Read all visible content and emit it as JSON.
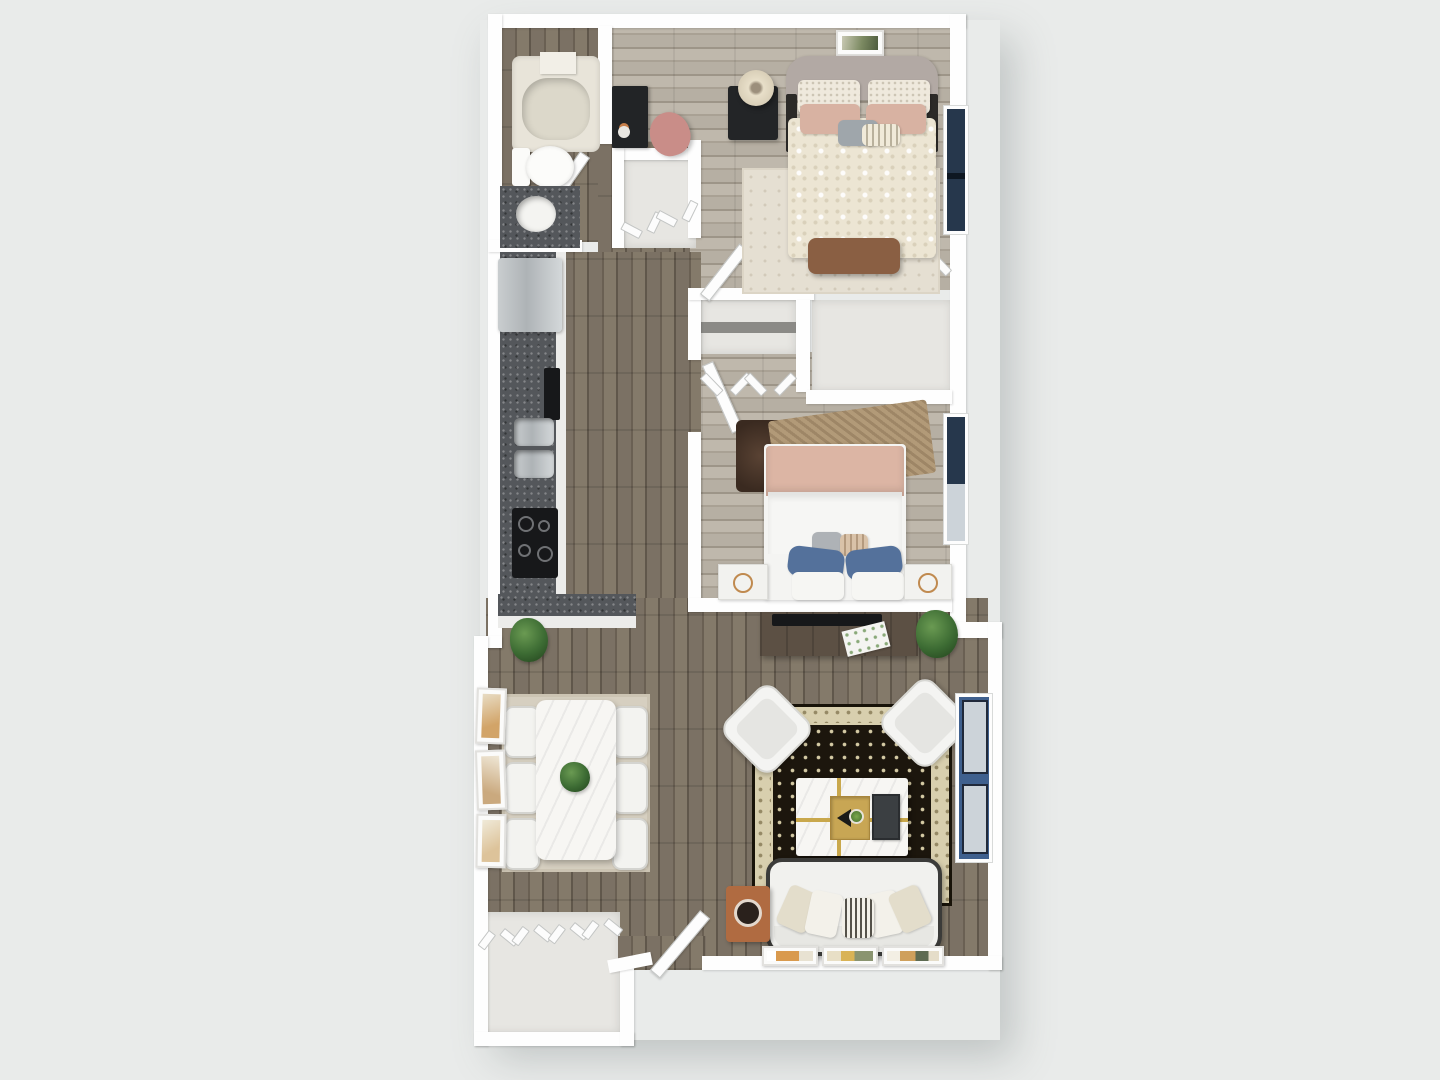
{
  "meta": {
    "title": "3D top-down floor plan render — 2 bedroom / 1 bath apartment",
    "render_style": "photoreal dollhouse top view",
    "visible_text": "none"
  },
  "palette": {
    "bg": "#e9ebea",
    "wall": "#fefefe",
    "wallEdge": "#d7d9d8",
    "floorDark": "#766d61",
    "floorLight": "#b4ada1",
    "closetFloor": "#e7e6e2",
    "counterSpeckle": "#54575b",
    "stainless": "#c2c6c8",
    "applianceBlack": "#17181a",
    "marble": "#f7f6f3",
    "goldInlay": "#c9a84c",
    "duvetCream": "#ece5d3",
    "blush": "#d8b2a2",
    "pillowBlue": "#54719b",
    "glassNavy": "#26374c",
    "glassBlue": "#3f608e",
    "paneLight": "#ccd3d9",
    "benchBrown": "#8a5f43",
    "terracotta": "#b06b41",
    "rugCream": "#e5dfd2",
    "rugBeige": "#d6cfc0",
    "rugBlackField": "#1c160d",
    "rugBorderCream": "#d8cfae",
    "consoleWood": "#5c5044",
    "plantGreen": "#3c6b33",
    "sofaWhite": "#f1f1ee",
    "sofaOutline": "#3b3b39",
    "headboardGray": "#b2a9a4"
  },
  "floor_plan": {
    "unit_type": "apartment",
    "counts": {
      "bedrooms": 2,
      "bathrooms": 1,
      "windows": 3,
      "dining_chairs": 6,
      "accent_chairs": 2,
      "closets": 4
    },
    "rooms": [
      {
        "id": "bathroom",
        "name": "Bathroom",
        "features": [
          "bathtub with shower shelf",
          "toilet",
          "dark speckled vanity with vessel sink",
          "swing door"
        ]
      },
      {
        "id": "primary-bedroom",
        "name": "Primary Bedroom",
        "features": [
          "upholstered bed with cream damask duvet",
          "gray headboard",
          "patterned pillows",
          "blush pillows",
          "striped accent pillow",
          "brown foot bench",
          "black nightstand",
          "cream table lamp",
          "framed wall art",
          "cream area rug",
          "black desk",
          "blush desk chair",
          "double bifold closet",
          "window"
        ]
      },
      {
        "id": "second-bedroom",
        "name": "Second Bedroom",
        "features": [
          "bed with blush throw blanket",
          "white duvet",
          "two navy pillows",
          "striped lumbar pillow",
          "two white nightstands with gold decor",
          "layered tan and dark shag rugs",
          "bifold closet",
          "window",
          "swing door"
        ]
      },
      {
        "id": "kitchen",
        "name": "Kitchen",
        "features": [
          "refrigerator",
          "wall oven",
          "double-basin stainless sink",
          "black cooktop",
          "dark speckled counters",
          "peninsula counter"
        ]
      },
      {
        "id": "dining-area",
        "name": "Dining Area",
        "features": [
          "white marble dining table",
          "green centerpiece",
          "six white chairs",
          "beige area rug",
          "corner potted plant",
          "three leaning art frames"
        ]
      },
      {
        "id": "living-room",
        "name": "Living Room",
        "features": [
          "media console with TV and papers",
          "potted plant",
          "two angled white accent chairs",
          "ornate black and cream oriental rug",
          "marble coffee table with gold inlay",
          "gold tray with fan and plant",
          "dark book",
          "white sofa with cream pillows and striped roll pillow",
          "terracotta pet-bed side table",
          "three framed prints along wall",
          "blue window"
        ]
      },
      {
        "id": "hallway",
        "name": "Hallway",
        "features": [
          "linen closet with bifold doors",
          "hall closet with bifold doors"
        ]
      },
      {
        "id": "entry",
        "name": "Entry",
        "features": [
          "angled entry door",
          "double bifold coat closet",
          "storage nook"
        ]
      }
    ]
  }
}
